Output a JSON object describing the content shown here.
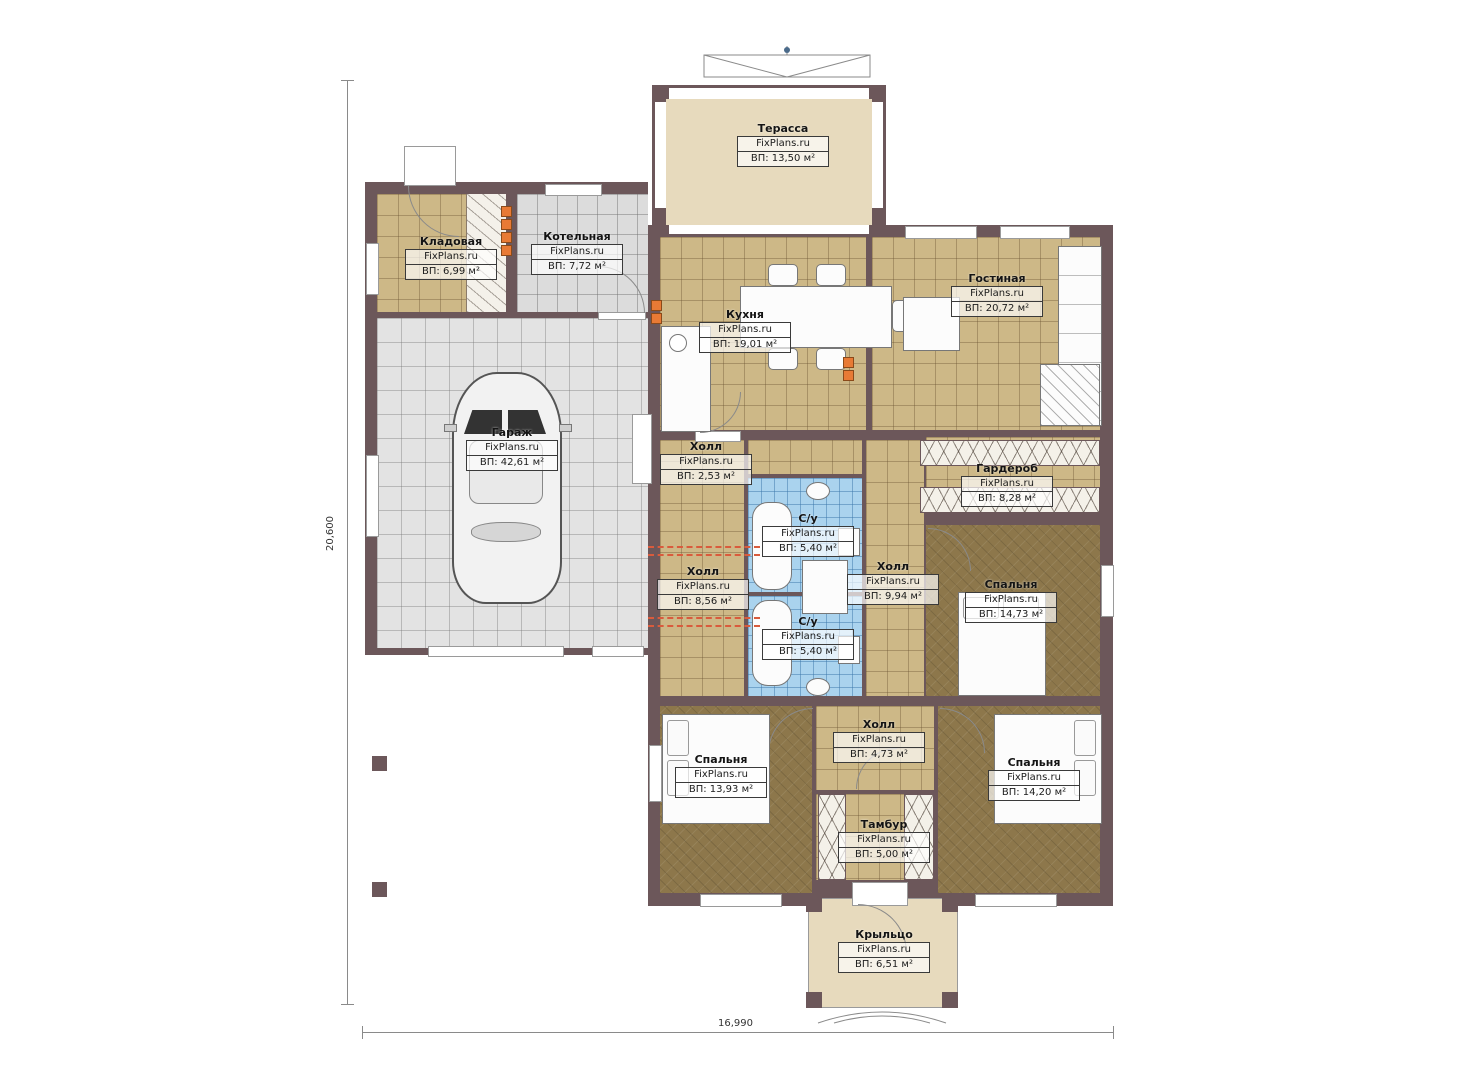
{
  "plan": {
    "width_label": "16,990",
    "height_label": "20,600"
  },
  "colors": {
    "wall": "#6c575a",
    "tile_tan": "#cdb887",
    "tile_gray": "#dcdcdc",
    "tile_blue": "#aad3ee",
    "carpet_brown": "#8d774b",
    "beige": "#e7dabd",
    "marker_orange": "#e87a35",
    "dashed_red": "#d95b3d"
  },
  "rooms": [
    {
      "name": "Терасса",
      "brand": "FixPlans.ru",
      "area": "ВП: 13,50 м²"
    },
    {
      "name": "Кладовая",
      "brand": "FixPlans.ru",
      "area": "ВП: 6,99 м²"
    },
    {
      "name": "Котельная",
      "brand": "FixPlans.ru",
      "area": "ВП: 7,72 м²"
    },
    {
      "name": "Кухня",
      "brand": "FixPlans.ru",
      "area": "ВП: 19,01 м²"
    },
    {
      "name": "Гостиная",
      "brand": "FixPlans.ru",
      "area": "ВП: 20,72 м²"
    },
    {
      "name": "Гараж",
      "brand": "FixPlans.ru",
      "area": "ВП: 42,61 м²"
    },
    {
      "name": "Холл",
      "brand": "FixPlans.ru",
      "area": "ВП: 2,53 м²"
    },
    {
      "name": "Гардероб",
      "brand": "FixPlans.ru",
      "area": "ВП: 8,28 м²"
    },
    {
      "name": "С/у",
      "brand": "FixPlans.ru",
      "area": "ВП: 5,40 м²"
    },
    {
      "name": "С/у",
      "brand": "FixPlans.ru",
      "area": "ВП: 5,40 м²"
    },
    {
      "name": "Холл",
      "brand": "FixPlans.ru",
      "area": "ВП: 8,56 м²"
    },
    {
      "name": "Холл",
      "brand": "FixPlans.ru",
      "area": "ВП: 9,94 м²"
    },
    {
      "name": "Спальня",
      "brand": "FixPlans.ru",
      "area": "ВП: 14,73 м²"
    },
    {
      "name": "Спальня",
      "brand": "FixPlans.ru",
      "area": "ВП: 13,93 м²"
    },
    {
      "name": "Холл",
      "brand": "FixPlans.ru",
      "area": "ВП: 4,73 м²"
    },
    {
      "name": "Тамбур",
      "brand": "FixPlans.ru",
      "area": "ВП: 5,00 м²"
    },
    {
      "name": "Спальня",
      "brand": "FixPlans.ru",
      "area": "ВП: 14,20 м²"
    },
    {
      "name": "Крыльцо",
      "brand": "FixPlans.ru",
      "area": "ВП: 6,51 м²"
    }
  ]
}
